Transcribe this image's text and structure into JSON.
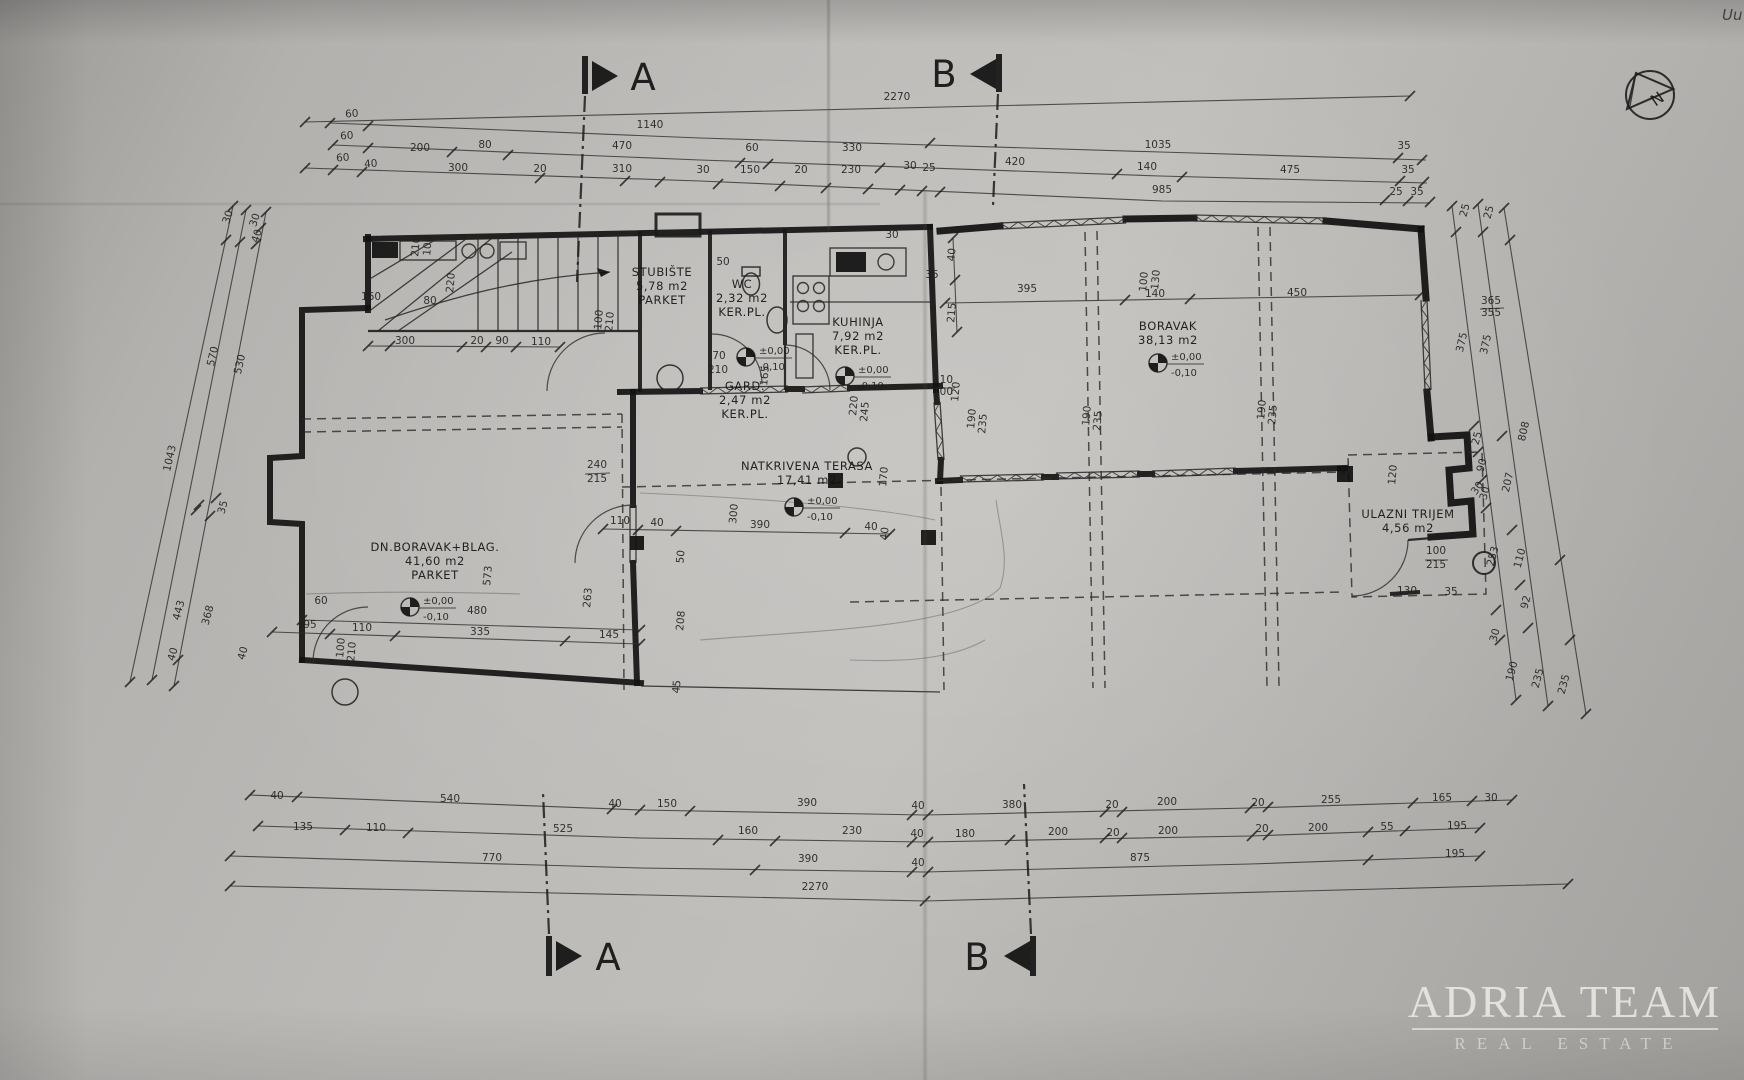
{
  "watermark": {
    "line1": "ADRIA TEAM",
    "line2": "REAL ESTATE"
  },
  "compass": {
    "label": "N"
  },
  "sections": {
    "a": "A",
    "b": "B"
  },
  "handwriting": "Uu",
  "level": {
    "upper": "±0,00",
    "lower": "-0,10"
  },
  "level_positions": [
    {
      "x": 746,
      "y": 357
    },
    {
      "x": 845,
      "y": 376
    },
    {
      "x": 1158,
      "y": 363
    },
    {
      "x": 794,
      "y": 507
    },
    {
      "x": 410,
      "y": 607
    }
  ],
  "rooms": [
    {
      "name": "STUBIŠTE",
      "area": "5,78 m2",
      "floor": "PARKET",
      "x": 662,
      "y": 276
    },
    {
      "name": "WC",
      "area": "2,32 m2",
      "floor": "KER.PL.",
      "x": 742,
      "y": 288
    },
    {
      "name": "GARD.",
      "area": "2,47 m2",
      "floor": "KER.PL.",
      "x": 745,
      "y": 390
    },
    {
      "name": "KUHINJA",
      "area": "7,92 m2",
      "floor": "KER.PL.",
      "x": 858,
      "y": 326
    },
    {
      "name": "BORAVAK",
      "area": "38,13 m2",
      "floor": "",
      "x": 1168,
      "y": 330
    },
    {
      "name": "DN.BORAVAK+BLAG.",
      "area": "41,60 m2",
      "floor": "PARKET",
      "x": 435,
      "y": 551
    },
    {
      "name": "NATKRIVENA TERASA",
      "area": "17,41 m2",
      "floor": "",
      "x": 807,
      "y": 470
    },
    {
      "name": "ULAZNI TRIJEM",
      "area": "4,56 m2",
      "floor": "",
      "x": 1408,
      "y": 518
    }
  ],
  "dims": [
    {
      "t": "2270",
      "x": 897,
      "y": 100
    },
    {
      "t": "1140",
      "x": 650,
      "y": 128
    },
    {
      "t": "1035",
      "x": 1158,
      "y": 148
    },
    {
      "t": "60",
      "x": 352,
      "y": 117,
      "r": -4
    },
    {
      "t": "60",
      "x": 347,
      "y": 139,
      "r": -4
    },
    {
      "t": "200",
      "x": 420,
      "y": 151
    },
    {
      "t": "80",
      "x": 485,
      "y": 148
    },
    {
      "t": "470",
      "x": 622,
      "y": 149
    },
    {
      "t": "60",
      "x": 752,
      "y": 151
    },
    {
      "t": "330",
      "x": 852,
      "y": 151
    },
    {
      "t": "420",
      "x": 1015,
      "y": 165
    },
    {
      "t": "140",
      "x": 1147,
      "y": 170
    },
    {
      "t": "475",
      "x": 1290,
      "y": 173
    },
    {
      "t": "35",
      "x": 1404,
      "y": 149
    },
    {
      "t": "35",
      "x": 1408,
      "y": 173
    },
    {
      "t": "60",
      "x": 343,
      "y": 161,
      "r": -4
    },
    {
      "t": "40",
      "x": 371,
      "y": 167,
      "r": -4
    },
    {
      "t": "300",
      "x": 458,
      "y": 171
    },
    {
      "t": "20",
      "x": 540,
      "y": 172
    },
    {
      "t": "310",
      "x": 622,
      "y": 172
    },
    {
      "t": "30",
      "x": 703,
      "y": 173
    },
    {
      "t": "150",
      "x": 750,
      "y": 173
    },
    {
      "t": "20",
      "x": 801,
      "y": 173
    },
    {
      "t": "230",
      "x": 851,
      "y": 173
    },
    {
      "t": "30",
      "x": 910,
      "y": 169
    },
    {
      "t": "25",
      "x": 929,
      "y": 171
    },
    {
      "t": "985",
      "x": 1162,
      "y": 193
    },
    {
      "t": "25",
      "x": 1396,
      "y": 195
    },
    {
      "t": "35",
      "x": 1417,
      "y": 195
    },
    {
      "t": "40",
      "x": 277,
      "y": 799
    },
    {
      "t": "540",
      "x": 450,
      "y": 802
    },
    {
      "t": "40",
      "x": 615,
      "y": 807
    },
    {
      "t": "150",
      "x": 667,
      "y": 807
    },
    {
      "t": "390",
      "x": 807,
      "y": 806
    },
    {
      "t": "40",
      "x": 918,
      "y": 809
    },
    {
      "t": "380",
      "x": 1012,
      "y": 808
    },
    {
      "t": "20",
      "x": 1112,
      "y": 808
    },
    {
      "t": "200",
      "x": 1167,
      "y": 805
    },
    {
      "t": "20",
      "x": 1258,
      "y": 806
    },
    {
      "t": "255",
      "x": 1331,
      "y": 803
    },
    {
      "t": "165",
      "x": 1442,
      "y": 801
    },
    {
      "t": "30",
      "x": 1491,
      "y": 801
    },
    {
      "t": "135",
      "x": 303,
      "y": 830
    },
    {
      "t": "110",
      "x": 376,
      "y": 831
    },
    {
      "t": "525",
      "x": 563,
      "y": 832
    },
    {
      "t": "160",
      "x": 748,
      "y": 834
    },
    {
      "t": "230",
      "x": 852,
      "y": 834
    },
    {
      "t": "40",
      "x": 917,
      "y": 837
    },
    {
      "t": "180",
      "x": 965,
      "y": 837
    },
    {
      "t": "200",
      "x": 1058,
      "y": 835
    },
    {
      "t": "20",
      "x": 1113,
      "y": 836
    },
    {
      "t": "200",
      "x": 1168,
      "y": 834
    },
    {
      "t": "20",
      "x": 1262,
      "y": 832
    },
    {
      "t": "200",
      "x": 1318,
      "y": 831
    },
    {
      "t": "55",
      "x": 1387,
      "y": 830
    },
    {
      "t": "195",
      "x": 1457,
      "y": 829
    },
    {
      "t": "770",
      "x": 492,
      "y": 861
    },
    {
      "t": "390",
      "x": 808,
      "y": 862
    },
    {
      "t": "40",
      "x": 918,
      "y": 866
    },
    {
      "t": "875",
      "x": 1140,
      "y": 861
    },
    {
      "t": "195",
      "x": 1455,
      "y": 857
    },
    {
      "t": "2270",
      "x": 815,
      "y": 890
    },
    {
      "t": "30",
      "x": 231,
      "y": 218,
      "r": -72
    },
    {
      "t": "30",
      "x": 258,
      "y": 221,
      "r": -72
    },
    {
      "t": "40",
      "x": 260,
      "y": 237,
      "r": -72
    },
    {
      "t": "570",
      "x": 216,
      "y": 357,
      "r": -77
    },
    {
      "t": "530",
      "x": 243,
      "y": 365,
      "r": -77
    },
    {
      "t": "1043",
      "x": 173,
      "y": 459,
      "r": -77
    },
    {
      "t": "35",
      "x": 226,
      "y": 508,
      "r": -75
    },
    {
      "t": "443",
      "x": 182,
      "y": 611,
      "r": -75
    },
    {
      "t": "368",
      "x": 211,
      "y": 616,
      "r": -75
    },
    {
      "t": "40",
      "x": 246,
      "y": 654,
      "r": -75
    },
    {
      "t": "40",
      "x": 176,
      "y": 655,
      "r": -75
    },
    {
      "t": "25",
      "x": 1468,
      "y": 211,
      "r": -75
    },
    {
      "t": "25",
      "x": 1492,
      "y": 213,
      "r": -75
    },
    {
      "t": "375",
      "x": 1465,
      "y": 343,
      "r": -77
    },
    {
      "t": "375",
      "x": 1489,
      "y": 345,
      "r": -77
    },
    {
      "t": "808",
      "x": 1527,
      "y": 432,
      "r": -77
    },
    {
      "t": "25",
      "x": 1480,
      "y": 439,
      "r": -75
    },
    {
      "t": "90",
      "x": 1485,
      "y": 466,
      "r": -75
    },
    {
      "t": "30",
      "x": 1488,
      "y": 494,
      "r": -75
    },
    {
      "t": "207",
      "x": 1511,
      "y": 483,
      "r": -77
    },
    {
      "t": "253",
      "x": 1496,
      "y": 557,
      "r": -75
    },
    {
      "t": "110",
      "x": 1523,
      "y": 559,
      "r": -75
    },
    {
      "t": "92",
      "x": 1529,
      "y": 603,
      "r": -75
    },
    {
      "t": "30",
      "x": 1498,
      "y": 636,
      "r": -75
    },
    {
      "t": "190",
      "x": 1515,
      "y": 672,
      "r": -75
    },
    {
      "t": "235",
      "x": 1541,
      "y": 679,
      "r": -75
    },
    {
      "t": "235",
      "x": 1567,
      "y": 685,
      "r": -75
    },
    {
      "t": "365",
      "x": 1491,
      "y": 304
    },
    {
      "t": "355",
      "x": 1491,
      "y": 316
    },
    {
      "t": "210",
      "x": 419,
      "y": 247,
      "r": -85
    },
    {
      "t": "100",
      "x": 431,
      "y": 246,
      "r": -85
    },
    {
      "t": "220",
      "x": 454,
      "y": 283,
      "r": -85
    },
    {
      "t": "160",
      "x": 371,
      "y": 300
    },
    {
      "t": "80",
      "x": 430,
      "y": 304
    },
    {
      "t": "300",
      "x": 405,
      "y": 344
    },
    {
      "t": "20",
      "x": 477,
      "y": 344
    },
    {
      "t": "90",
      "x": 502,
      "y": 344
    },
    {
      "t": "110",
      "x": 541,
      "y": 345
    },
    {
      "t": "100",
      "x": 602,
      "y": 320,
      "r": -85
    },
    {
      "t": "210",
      "x": 613,
      "y": 322,
      "r": -85
    },
    {
      "t": "50",
      "x": 723,
      "y": 265
    },
    {
      "t": "70",
      "x": 719,
      "y": 359
    },
    {
      "t": "210",
      "x": 718,
      "y": 373
    },
    {
      "t": "165",
      "x": 768,
      "y": 376,
      "r": -85
    },
    {
      "t": "110",
      "x": 943,
      "y": 383
    },
    {
      "t": "100",
      "x": 943,
      "y": 395
    },
    {
      "t": "120",
      "x": 959,
      "y": 392,
      "r": -85
    },
    {
      "t": "30",
      "x": 892,
      "y": 238
    },
    {
      "t": "35",
      "x": 932,
      "y": 278
    },
    {
      "t": "40",
      "x": 955,
      "y": 255,
      "r": -85
    },
    {
      "t": "215",
      "x": 955,
      "y": 313,
      "r": -85
    },
    {
      "t": "395",
      "x": 1027,
      "y": 292
    },
    {
      "t": "100",
      "x": 1147,
      "y": 282,
      "r": -85
    },
    {
      "t": "130",
      "x": 1159,
      "y": 280,
      "r": -85
    },
    {
      "t": "140",
      "x": 1155,
      "y": 297
    },
    {
      "t": "450",
      "x": 1297,
      "y": 296
    },
    {
      "t": "220",
      "x": 857,
      "y": 406,
      "r": -85
    },
    {
      "t": "245",
      "x": 868,
      "y": 412,
      "r": -85
    },
    {
      "t": "190",
      "x": 975,
      "y": 419,
      "r": -85
    },
    {
      "t": "235",
      "x": 986,
      "y": 424,
      "r": -85
    },
    {
      "t": "190",
      "x": 1090,
      "y": 416,
      "r": -85
    },
    {
      "t": "235",
      "x": 1101,
      "y": 421,
      "r": -85
    },
    {
      "t": "190",
      "x": 1265,
      "y": 410,
      "r": -85
    },
    {
      "t": "235",
      "x": 1276,
      "y": 415,
      "r": -85
    },
    {
      "t": "240",
      "x": 597,
      "y": 468
    },
    {
      "t": "215",
      "x": 597,
      "y": 482
    },
    {
      "t": "170",
      "x": 887,
      "y": 477,
      "r": -85
    },
    {
      "t": "300",
      "x": 737,
      "y": 514,
      "r": -85
    },
    {
      "t": "110",
      "x": 620,
      "y": 524
    },
    {
      "t": "40",
      "x": 657,
      "y": 526
    },
    {
      "t": "390",
      "x": 760,
      "y": 528
    },
    {
      "t": "40",
      "x": 871,
      "y": 530
    },
    {
      "t": "40",
      "x": 888,
      "y": 534,
      "r": -85
    },
    {
      "t": "50",
      "x": 684,
      "y": 557,
      "r": -85
    },
    {
      "t": "573",
      "x": 491,
      "y": 576,
      "r": -85
    },
    {
      "t": "60",
      "x": 321,
      "y": 604
    },
    {
      "t": "480",
      "x": 477,
      "y": 614
    },
    {
      "t": "263",
      "x": 591,
      "y": 598,
      "r": -85
    },
    {
      "t": "208",
      "x": 684,
      "y": 621,
      "r": -85
    },
    {
      "t": "45",
      "x": 680,
      "y": 687,
      "r": -85
    },
    {
      "t": "95",
      "x": 310,
      "y": 628
    },
    {
      "t": "110",
      "x": 362,
      "y": 631
    },
    {
      "t": "335",
      "x": 480,
      "y": 635
    },
    {
      "t": "145",
      "x": 609,
      "y": 638
    },
    {
      "t": "100",
      "x": 344,
      "y": 648,
      "r": -85
    },
    {
      "t": "210",
      "x": 355,
      "y": 652,
      "r": -85
    },
    {
      "t": "120",
      "x": 1396,
      "y": 475,
      "r": -85
    },
    {
      "t": "30",
      "x": 1480,
      "y": 490,
      "r": -55
    },
    {
      "t": "100",
      "x": 1436,
      "y": 554
    },
    {
      "t": "215",
      "x": 1436,
      "y": 568
    },
    {
      "t": "130",
      "x": 1407,
      "y": 594
    },
    {
      "t": "35",
      "x": 1451,
      "y": 595
    }
  ]
}
